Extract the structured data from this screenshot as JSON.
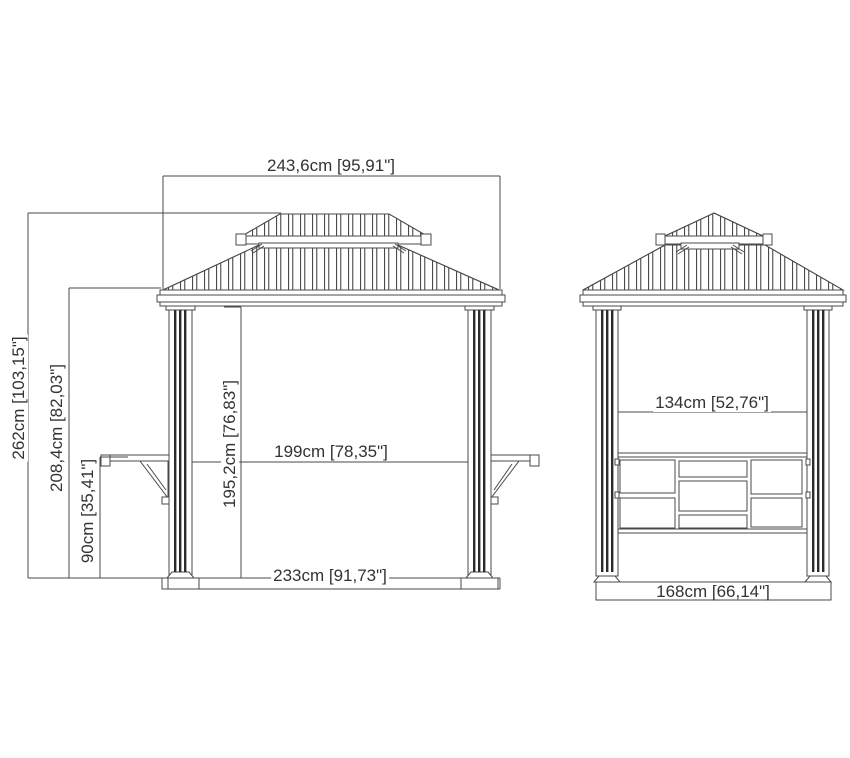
{
  "front_view": {
    "dims": {
      "roof_width": "243,6cm [95,91\"]",
      "total_height": "262cm [103,15\"]",
      "eave_height": "208,4cm [82,03\"]",
      "shelf_height": "90cm [35,41\"]",
      "clearance_height": "195,2cm [76,83\"]",
      "inner_width": "199cm [78,35\"]",
      "base_width": "233cm [91,73\"]"
    }
  },
  "side_view": {
    "dims": {
      "inner_width": "134cm [52,76\"]",
      "base_width": "168cm [66,14\"]"
    }
  },
  "style": {
    "line_color": "#4a4a4a",
    "text_color": "#333333",
    "background": "#ffffff"
  }
}
